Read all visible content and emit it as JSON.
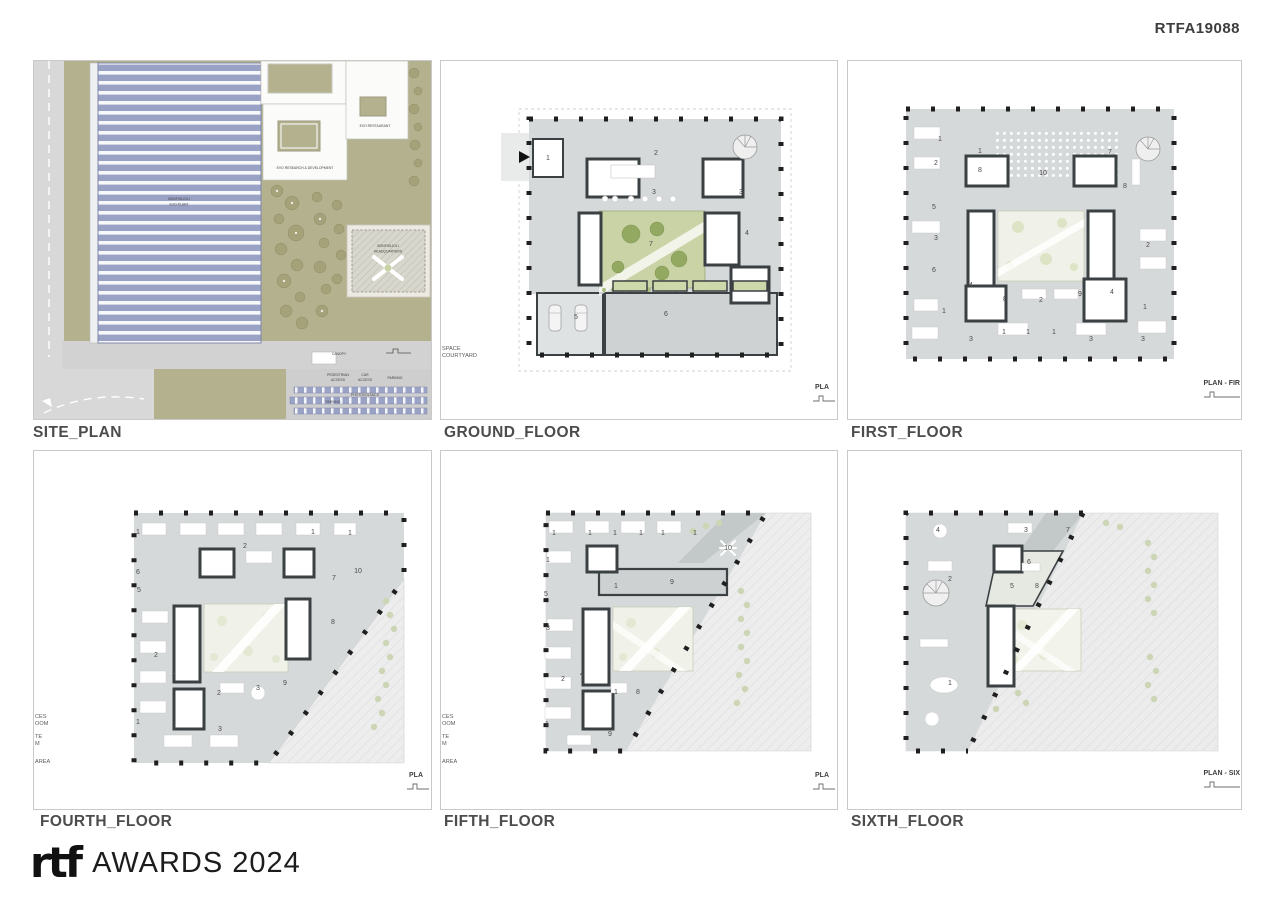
{
  "header": {
    "code": "RTFA19088"
  },
  "site": {
    "title": "SITE_PLAN",
    "plant_line1": "BONFIGLIOLI",
    "plant_line2": "EVO PLANT",
    "rnd_label": "EVO RESEARCH & DEVELOPMENT",
    "restaurant_label": "EVO RESTAURANT",
    "hq_line1": "BONFIGLIOLI",
    "hq_line2": "HEADQUARTERS",
    "canopy_label": "CANOPY",
    "pedestrian_line1": "PEDESTRIAN",
    "pedestrian_line2": "ACCESS",
    "car_line1": "CAR",
    "car_line2": "ACCESS",
    "parking_top": "PARKING",
    "photovoltaics": "PHOTOVOLTAICS",
    "parking_bottom": "PARKING"
  },
  "ground": {
    "title": "GROUND_FLOOR",
    "corner_label": "PLA",
    "legend": [
      "SPACE",
      "COURTYARD"
    ],
    "rooms": [
      "1",
      "2",
      "3",
      "3",
      "4",
      "7",
      "5",
      "6"
    ]
  },
  "first": {
    "title": "FIRST_FLOOR",
    "corner_label": "PLAN - FIR",
    "rooms": [
      "1",
      "1",
      "2",
      "8",
      "10",
      "7",
      "8",
      "5",
      "3",
      "6",
      "2",
      "4",
      "8",
      "2",
      "9",
      "4",
      "1",
      "1",
      "1",
      "1",
      "3",
      "3",
      "3",
      "1"
    ]
  },
  "fourth": {
    "title": "FOURTH_FLOOR",
    "corner_label": "PLA",
    "legend": [
      "CES",
      "OOM",
      "TE",
      "M",
      "AREA"
    ],
    "rooms": [
      "1",
      "1",
      "1",
      "2",
      "6",
      "10",
      "7",
      "5",
      "8",
      "2",
      "4",
      "2",
      "3",
      "9",
      "1",
      "3",
      "3"
    ]
  },
  "fifth": {
    "title": "FIFTH_FLOOR",
    "corner_label": "PLA",
    "legend": [
      "CES",
      "OOM",
      "TE",
      "M",
      "AREA"
    ],
    "rooms": [
      "1",
      "1",
      "1",
      "1",
      "1",
      "1",
      "1",
      "10",
      "9",
      "1",
      "5",
      "3",
      "2",
      "4",
      "1",
      "8",
      "1",
      "9"
    ]
  },
  "sixth": {
    "title": "SIXTH_FLOOR",
    "corner_label": "PLAN - SIX",
    "rooms": [
      "4",
      "3",
      "7",
      "6",
      "2",
      "5",
      "8",
      "1"
    ]
  },
  "footer": {
    "logo": "rtf",
    "awards": "AWARDS 2024"
  },
  "colors": {
    "olive": "#b4b18f",
    "plant_blue": "#99a1c5",
    "floor_gray": "#d6d9da",
    "wall": "#3b4043",
    "courtyard_green": "#c9d3a6",
    "skylight": "#f0f1e8"
  }
}
